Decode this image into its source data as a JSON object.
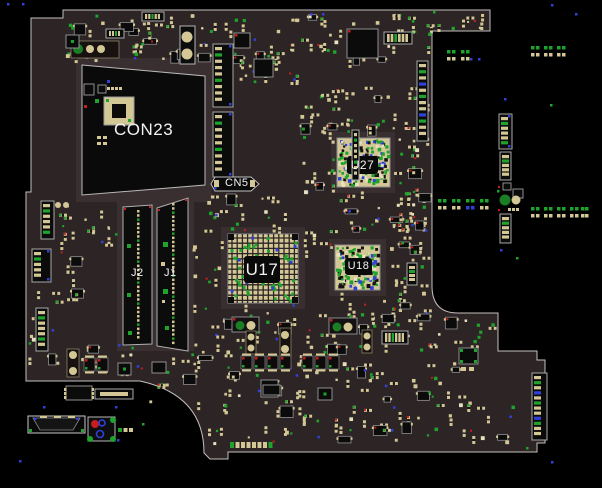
{
  "view": {
    "name": "pcb-boardview",
    "width": 602,
    "height": 488
  },
  "colors": {
    "background": "#000000",
    "board": "#2d2425",
    "halo": "#3a2f30",
    "edge": "#c4c0bc",
    "pad": "#d3c795",
    "pad_light": "#e8e1bd",
    "green": "#1ea32c",
    "green_dark": "#1b7e24",
    "blue": "#3141d8",
    "red": "#c81d1d",
    "body": "#0b0b0b",
    "chip_stroke": "#8f8f8f",
    "outline": "#b9b9b9",
    "text": "#f2f2f2"
  },
  "labels": {
    "con23": {
      "text": "CON23",
      "x": 114,
      "y": 121,
      "size": 17
    },
    "cn5": {
      "text": "CN5",
      "x": 225,
      "y": 178,
      "size": 11
    },
    "u27": {
      "text": "U27",
      "x": 347,
      "y": 156,
      "w": 31,
      "h": 18,
      "size": 12
    },
    "u17": {
      "text": "U17",
      "x": 244,
      "y": 256,
      "w": 36,
      "h": 27,
      "size": 17
    },
    "u18": {
      "text": "U18",
      "x": 345,
      "y": 258,
      "w": 27,
      "h": 17,
      "size": 11
    },
    "j2": {
      "text": "J2",
      "x": 131,
      "y": 268,
      "size": 11
    },
    "j1": {
      "text": "J1",
      "x": 164,
      "y": 268,
      "size": 11
    }
  },
  "board": {
    "outline_path": "M31,18 H63 V10 H490 V31 H432 V286 Q432,313 458,313 H498 V351 H537 V360 H545 V443 H537 V452 H228 V459 H210 L204,453 Q204,395 140,381 H26 V192 H31 Z"
  },
  "halos": [
    {
      "x": 76,
      "y": 58,
      "w": 136,
      "h": 144
    },
    {
      "x": 117,
      "y": 197,
      "w": 77,
      "h": 154
    },
    {
      "x": 221,
      "y": 227,
      "w": 84,
      "h": 82
    },
    {
      "x": 331,
      "y": 132,
      "w": 64,
      "h": 61
    },
    {
      "x": 329,
      "y": 239,
      "w": 57,
      "h": 57
    }
  ],
  "components": [
    {
      "t": "quad",
      "name": "CON23",
      "pts": "82,65 205,76 205,185 82,195"
    },
    {
      "t": "chip",
      "x": 84,
      "y": 84,
      "w": 10,
      "h": 11
    },
    {
      "t": "chip",
      "x": 98,
      "y": 85,
      "w": 8,
      "h": 8
    },
    {
      "t": "padrow",
      "x": 107,
      "y": 87,
      "n": 4,
      "pw": 3,
      "ph": 3,
      "gap": 1,
      "c": "pad"
    },
    {
      "t": "tanblock",
      "x": 104,
      "y": 97,
      "w": 30,
      "h": 28
    },
    {
      "t": "dotc",
      "x": 95,
      "y": 99,
      "c": "green",
      "s": 4
    },
    {
      "t": "dotc",
      "x": 84,
      "y": 105,
      "c": "red",
      "s": 3
    },
    {
      "t": "dotc",
      "x": 107,
      "y": 80,
      "c": "blue",
      "s": 3
    },
    {
      "t": "padrow",
      "x": 97,
      "y": 136,
      "n": 2,
      "pw": 4,
      "ph": 3,
      "gap": 2,
      "c": "pad"
    },
    {
      "t": "padrow",
      "x": 97,
      "y": 142,
      "n": 2,
      "pw": 4,
      "ph": 3,
      "gap": 2,
      "c": "pad"
    },
    {
      "t": "slot",
      "name": "J2",
      "pts": "123,207 152,205 152,344 123,345",
      "cx": 137,
      "y1": 210,
      "y2": 340
    },
    {
      "t": "slot",
      "name": "J1",
      "pts": "157,208 188,198 188,351 157,346",
      "cx": 172,
      "y1": 203,
      "y2": 345
    },
    {
      "t": "dotc",
      "x": 127,
      "y": 244,
      "c": "green",
      "s": 4
    },
    {
      "t": "dotc",
      "x": 127,
      "y": 293,
      "c": "green",
      "s": 4
    },
    {
      "t": "dotc",
      "x": 128,
      "y": 331,
      "c": "green",
      "s": 4
    },
    {
      "t": "dotc",
      "x": 163,
      "y": 242,
      "c": "green",
      "s": 5
    },
    {
      "t": "dotc",
      "x": 163,
      "y": 289,
      "c": "green",
      "s": 5
    },
    {
      "t": "dotc",
      "x": 165,
      "y": 326,
      "c": "green",
      "s": 4
    },
    {
      "t": "dotc",
      "x": 161,
      "y": 262,
      "c": "pad",
      "s": 4
    },
    {
      "t": "dotc",
      "x": 162,
      "y": 300,
      "c": "pad",
      "s": 3
    },
    {
      "t": "connv",
      "name": "slot-a",
      "x": 213,
      "y": 44,
      "w": 20,
      "h": 63,
      "pads": 9,
      "blue": 1
    },
    {
      "t": "connv",
      "name": "slot-b",
      "x": 213,
      "y": 112,
      "w": 20,
      "h": 65,
      "pads": 9,
      "blue": 1
    },
    {
      "t": "cn5shape",
      "name": "CN5-conn",
      "x": 211,
      "y": 177,
      "w": 48,
      "h": 14
    },
    {
      "t": "box2circ",
      "x": 180,
      "y": 26,
      "w": 15,
      "h": 38,
      "c1": [
        187,
        37,
        5.5
      ],
      "c2": [
        187,
        54,
        5.5
      ]
    },
    {
      "t": "chip",
      "x": 234,
      "y": 33,
      "w": 16,
      "h": 15,
      "red": 1
    },
    {
      "t": "chip",
      "x": 254,
      "y": 59,
      "w": 19,
      "h": 18
    },
    {
      "t": "chip",
      "x": 347,
      "y": 29,
      "w": 31,
      "h": 29,
      "red": 1
    },
    {
      "t": "connh",
      "x": 384,
      "y": 32,
      "w": 28,
      "h": 12,
      "pads": 6
    },
    {
      "t": "connv",
      "x": 417,
      "y": 61,
      "w": 11,
      "h": 80,
      "pads": 12,
      "mix": 1
    },
    {
      "t": "barcirc",
      "x": 71,
      "y": 41,
      "w": 48,
      "h": 17,
      "circles": [
        [
          78,
          49,
          5,
          "green_dark"
        ],
        [
          90,
          49,
          4,
          "pad"
        ],
        [
          101,
          49,
          4,
          "pad"
        ]
      ]
    },
    {
      "t": "chip",
      "x": 66,
      "y": 35,
      "w": 13,
      "h": 13,
      "gdot": 1
    },
    {
      "t": "connh",
      "x": 142,
      "y": 12,
      "w": 22,
      "h": 9,
      "pads": 5
    },
    {
      "t": "connh",
      "x": 106,
      "y": 29,
      "w": 18,
      "h": 9,
      "pads": 4
    },
    {
      "t": "bga",
      "name": "U27",
      "x": 337,
      "y": 138,
      "w": 53,
      "h": 49,
      "lb": [
        347,
        156,
        31,
        18
      ],
      "style": "dense",
      "seed": 71
    },
    {
      "t": "bga",
      "name": "U17",
      "x": 228,
      "y": 234,
      "w": 70,
      "h": 69,
      "lb": [
        244,
        256,
        36,
        27
      ],
      "style": "grid",
      "seed": 72
    },
    {
      "t": "bga",
      "name": "U18",
      "x": 335,
      "y": 245,
      "w": 45,
      "h": 45,
      "lb": [
        345,
        258,
        27,
        17
      ],
      "style": "dense",
      "seed": 73
    },
    {
      "t": "connv",
      "x": 352,
      "y": 130,
      "w": 7,
      "h": 50,
      "pads": 8
    },
    {
      "t": "connv",
      "x": 407,
      "y": 263,
      "w": 10,
      "h": 22,
      "pads": 4
    },
    {
      "t": "connh",
      "x": 382,
      "y": 331,
      "w": 26,
      "h": 13,
      "pads": 6
    },
    {
      "t": "chip",
      "x": 459,
      "y": 348,
      "w": 19,
      "h": 16,
      "gcorners": 1
    },
    {
      "t": "padrow",
      "x": 461,
      "y": 367,
      "n": 2,
      "pw": 5,
      "ph": 4,
      "gap": 3,
      "c": "pad"
    },
    {
      "t": "connv",
      "name": "edge-conn",
      "x": 532,
      "y": 373,
      "w": 15,
      "h": 67,
      "pads": 12,
      "mix": 1
    },
    {
      "t": "cappair",
      "x": 232,
      "y": 317,
      "w": 27,
      "h": 15
    },
    {
      "t": "cappair",
      "x": 329,
      "y": 318,
      "w": 28,
      "h": 16
    },
    {
      "t": "barcirc",
      "x": 246,
      "y": 331,
      "w": 10,
      "h": 23,
      "circles": [
        [
          251,
          337,
          3.5,
          "pad"
        ],
        [
          251,
          348,
          3.5,
          "pad"
        ]
      ]
    },
    {
      "t": "barcirc",
      "x": 280,
      "y": 328,
      "w": 11,
      "h": 28,
      "circles": [
        [
          285,
          335,
          4,
          "pad"
        ],
        [
          285,
          349,
          4,
          "pad"
        ]
      ]
    },
    {
      "t": "barcirc",
      "x": 362,
      "y": 330,
      "w": 10,
      "h": 23,
      "circles": [
        [
          367,
          336,
          3.5,
          "pad"
        ],
        [
          367,
          347,
          3.5,
          "pad"
        ]
      ]
    },
    {
      "t": "cap",
      "x": 241,
      "y": 356
    },
    {
      "t": "cap",
      "x": 254,
      "y": 356
    },
    {
      "t": "cap",
      "x": 267,
      "y": 356
    },
    {
      "t": "cap",
      "x": 280,
      "y": 356
    },
    {
      "t": "cap",
      "x": 302,
      "y": 356
    },
    {
      "t": "cap",
      "x": 315,
      "y": 356
    },
    {
      "t": "cap",
      "x": 328,
      "y": 356
    },
    {
      "t": "chip",
      "x": 261,
      "y": 380,
      "w": 17,
      "h": 17
    },
    {
      "t": "chip",
      "x": 318,
      "y": 388,
      "w": 14,
      "h": 12,
      "gdot": 1
    },
    {
      "t": "chip",
      "x": 263,
      "y": 385,
      "w": 17,
      "h": 10
    },
    {
      "t": "chip",
      "x": 152,
      "y": 362,
      "w": 14,
      "h": 11
    },
    {
      "t": "barcirc",
      "x": 67,
      "y": 349,
      "w": 12,
      "h": 28,
      "circles": [
        [
          73,
          355,
          4,
          "pad"
        ],
        [
          73,
          371,
          4,
          "pad"
        ]
      ]
    },
    {
      "t": "cap",
      "x": 84,
      "y": 358
    },
    {
      "t": "cap",
      "x": 97,
      "y": 358
    },
    {
      "t": "chip",
      "x": 118,
      "y": 363,
      "w": 13,
      "h": 12,
      "gdot": 1
    },
    {
      "t": "connv",
      "x": 41,
      "y": 201,
      "w": 13,
      "h": 38,
      "pads": 6
    },
    {
      "t": "connv",
      "x": 32,
      "y": 249,
      "w": 19,
      "h": 33,
      "pads": 5,
      "blue": 1
    },
    {
      "t": "connv",
      "x": 36,
      "y": 308,
      "w": 12,
      "h": 43,
      "pads": 7
    },
    {
      "t": "circ",
      "cx": 58,
      "cy": 205,
      "r": 3,
      "c": "pad"
    },
    {
      "t": "circ",
      "cx": 66,
      "cy": 205,
      "r": 3,
      "c": "pad"
    },
    {
      "t": "connh",
      "x": 95,
      "y": 389,
      "w": 38,
      "h": 10,
      "bar": 1
    },
    {
      "t": "chip",
      "x": 66,
      "y": 386,
      "w": 26,
      "h": 14,
      "sidepads": 1
    },
    {
      "t": "padrow",
      "x": 230,
      "y": 442,
      "n": 8,
      "pw": 4,
      "ph": 6,
      "gap": 1.5,
      "c": "pad",
      "gends": 1
    },
    {
      "t": "trap",
      "name": "float-conn",
      "x": 28,
      "y": 416,
      "w": 57,
      "h": 17
    },
    {
      "t": "ringbox",
      "name": "float-pad",
      "x": 88,
      "y": 417,
      "w": 27,
      "h": 24
    },
    {
      "t": "padrow",
      "x": 118,
      "y": 428,
      "n": 3,
      "pw": 4,
      "ph": 4,
      "gap": 1.5,
      "c": "mixg"
    },
    {
      "t": "connv",
      "x": 499,
      "y": 114,
      "w": 13,
      "h": 35,
      "pads": 6,
      "blue": 1
    },
    {
      "t": "connv",
      "x": 500,
      "y": 152,
      "w": 11,
      "h": 28,
      "pads": 5
    },
    {
      "t": "connv",
      "x": 500,
      "y": 214,
      "w": 11,
      "h": 29,
      "pads": 5
    },
    {
      "t": "chip",
      "x": 503,
      "y": 183,
      "w": 8,
      "h": 7
    },
    {
      "t": "chip",
      "x": 513,
      "y": 189,
      "w": 10,
      "h": 9
    },
    {
      "t": "circ",
      "cx": 505,
      "cy": 200,
      "r": 5.5,
      "c": "green_dark"
    },
    {
      "t": "circ",
      "cx": 516,
      "cy": 200,
      "r": 4.5,
      "c": "pad"
    },
    {
      "t": "dotc",
      "x": 498,
      "y": 186,
      "c": "red",
      "s": 2
    },
    {
      "t": "dotc",
      "x": 498,
      "y": 209,
      "c": "red",
      "s": 2
    },
    {
      "t": "padrow",
      "x": 508,
      "y": 208,
      "n": 3,
      "pw": 3,
      "ph": 3,
      "gap": 1,
      "c": "pad"
    }
  ],
  "pad_groups": [
    {
      "x": 447,
      "y": 50,
      "xs": [
        0,
        5,
        14,
        19
      ],
      "blues": []
    },
    {
      "x": 531,
      "y": 46,
      "xs": [
        0,
        5,
        13,
        18,
        26,
        31
      ],
      "blues": []
    },
    {
      "x": 438,
      "y": 199,
      "xs": [
        0,
        5,
        14,
        19,
        28,
        33,
        42,
        47
      ],
      "blues": [
        28,
        33
      ]
    },
    {
      "x": 531,
      "y": 207,
      "xs": [
        0,
        5,
        13,
        18,
        26,
        31,
        39,
        44
      ],
      "blues": []
    },
    {
      "x": 581,
      "y": 207,
      "xs": [
        0,
        4
      ],
      "blues": []
    }
  ],
  "clusters": [
    {
      "x": 64,
      "y": 12,
      "w": 140,
      "h": 46,
      "n": 44,
      "seed": 1
    },
    {
      "x": 206,
      "y": 14,
      "w": 148,
      "h": 46,
      "n": 40,
      "seed": 2
    },
    {
      "x": 356,
      "y": 12,
      "w": 74,
      "h": 46,
      "n": 26,
      "seed": 3
    },
    {
      "x": 436,
      "y": 13,
      "w": 52,
      "h": 15,
      "n": 9,
      "seed": 4
    },
    {
      "x": 236,
      "y": 42,
      "w": 64,
      "h": 42,
      "n": 28,
      "seed": 5
    },
    {
      "x": 300,
      "y": 86,
      "w": 128,
      "h": 48,
      "n": 44,
      "seed": 6
    },
    {
      "x": 302,
      "y": 136,
      "w": 34,
      "h": 58,
      "n": 14,
      "seed": 7
    },
    {
      "x": 392,
      "y": 136,
      "w": 38,
      "h": 72,
      "n": 20,
      "seed": 8
    },
    {
      "x": 338,
      "y": 190,
      "w": 88,
      "h": 38,
      "n": 28,
      "seed": 9
    },
    {
      "x": 198,
      "y": 194,
      "w": 86,
      "h": 36,
      "n": 24,
      "seed": 10
    },
    {
      "x": 84,
      "y": 198,
      "w": 34,
      "h": 46,
      "n": 10,
      "seed": 11
    },
    {
      "x": 52,
      "y": 198,
      "w": 28,
      "h": 104,
      "n": 14,
      "seed": 12
    },
    {
      "x": 28,
      "y": 286,
      "w": 48,
      "h": 86,
      "n": 16,
      "seed": 13
    },
    {
      "x": 192,
      "y": 302,
      "w": 112,
      "h": 54,
      "n": 34,
      "seed": 14
    },
    {
      "x": 306,
      "y": 302,
      "w": 124,
      "h": 54,
      "n": 34,
      "seed": 15
    },
    {
      "x": 336,
      "y": 292,
      "w": 92,
      "h": 32,
      "n": 20,
      "seed": 16
    },
    {
      "x": 384,
      "y": 238,
      "w": 46,
      "h": 58,
      "n": 18,
      "seed": 17
    },
    {
      "x": 300,
      "y": 226,
      "w": 40,
      "h": 26,
      "n": 10,
      "seed": 18
    },
    {
      "x": 210,
      "y": 362,
      "w": 138,
      "h": 36,
      "n": 30,
      "seed": 19
    },
    {
      "x": 352,
      "y": 362,
      "w": 118,
      "h": 36,
      "n": 24,
      "seed": 20
    },
    {
      "x": 206,
      "y": 400,
      "w": 184,
      "h": 44,
      "n": 36,
      "seed": 21
    },
    {
      "x": 392,
      "y": 400,
      "w": 126,
      "h": 42,
      "n": 24,
      "seed": 22
    },
    {
      "x": 432,
      "y": 316,
      "w": 60,
      "h": 30,
      "n": 12,
      "seed": 23
    },
    {
      "x": 66,
      "y": 344,
      "w": 82,
      "h": 30,
      "n": 14,
      "seed": 24
    },
    {
      "x": 146,
      "y": 352,
      "w": 56,
      "h": 52,
      "n": 14,
      "seed": 25
    },
    {
      "x": 190,
      "y": 240,
      "w": 32,
      "h": 52,
      "n": 10,
      "seed": 26
    },
    {
      "x": 392,
      "y": 210,
      "w": 36,
      "h": 28,
      "n": 10,
      "seed": 27
    }
  ],
  "dots": [
    [
      7,
      3,
      "blue"
    ],
    [
      22,
      3,
      "blue"
    ],
    [
      310,
      13,
      "blue"
    ],
    [
      322,
      13,
      "blue"
    ],
    [
      433,
      11,
      "green"
    ],
    [
      551,
      4,
      "blue"
    ],
    [
      575,
      13,
      "blue"
    ],
    [
      504,
      98,
      "blue"
    ],
    [
      550,
      104,
      "green"
    ],
    [
      497,
      190,
      "green"
    ],
    [
      470,
      58,
      "blue"
    ],
    [
      478,
      58,
      "blue"
    ],
    [
      500,
      249,
      "blue"
    ],
    [
      516,
      257,
      "green"
    ],
    [
      551,
      461,
      "blue"
    ],
    [
      115,
      406,
      "blue"
    ],
    [
      43,
      406,
      "blue"
    ],
    [
      117,
      439,
      "blue"
    ],
    [
      142,
      423,
      "green"
    ],
    [
      19,
      460,
      "blue"
    ],
    [
      391,
      429,
      "blue"
    ],
    [
      526,
      447,
      "green"
    ]
  ]
}
